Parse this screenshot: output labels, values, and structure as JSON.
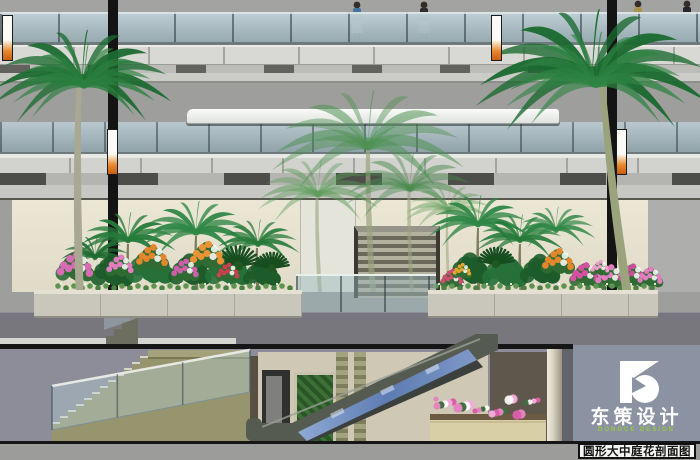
{
  "branding": {
    "logo_mark": "D",
    "name": "东策设计",
    "name_en": "DONGCE DESIGN",
    "panel_color": "#8b92a2",
    "accent_green": "#97c93d"
  },
  "caption": {
    "text": "圆形大中庭花剖面图"
  },
  "palette": {
    "wall_gray": "#9e9e9c",
    "glass": "#bccdd3",
    "beige_wall": "#ebe7d5",
    "slab_gray": "#77777d",
    "basement_gray": "#8c8d98",
    "palm_green_dark": "#1c6b31",
    "palm_green_light": "#4f9153",
    "flower_pink": "#e27ec0",
    "flower_orange": "#e4862c",
    "escalator_mosaic": "#5d7cb2",
    "stair_khaki": "#96956d"
  },
  "scene_notes": {
    "drawing_type": "atrium-section",
    "people_count": 4,
    "hanging_banners": 4
  }
}
